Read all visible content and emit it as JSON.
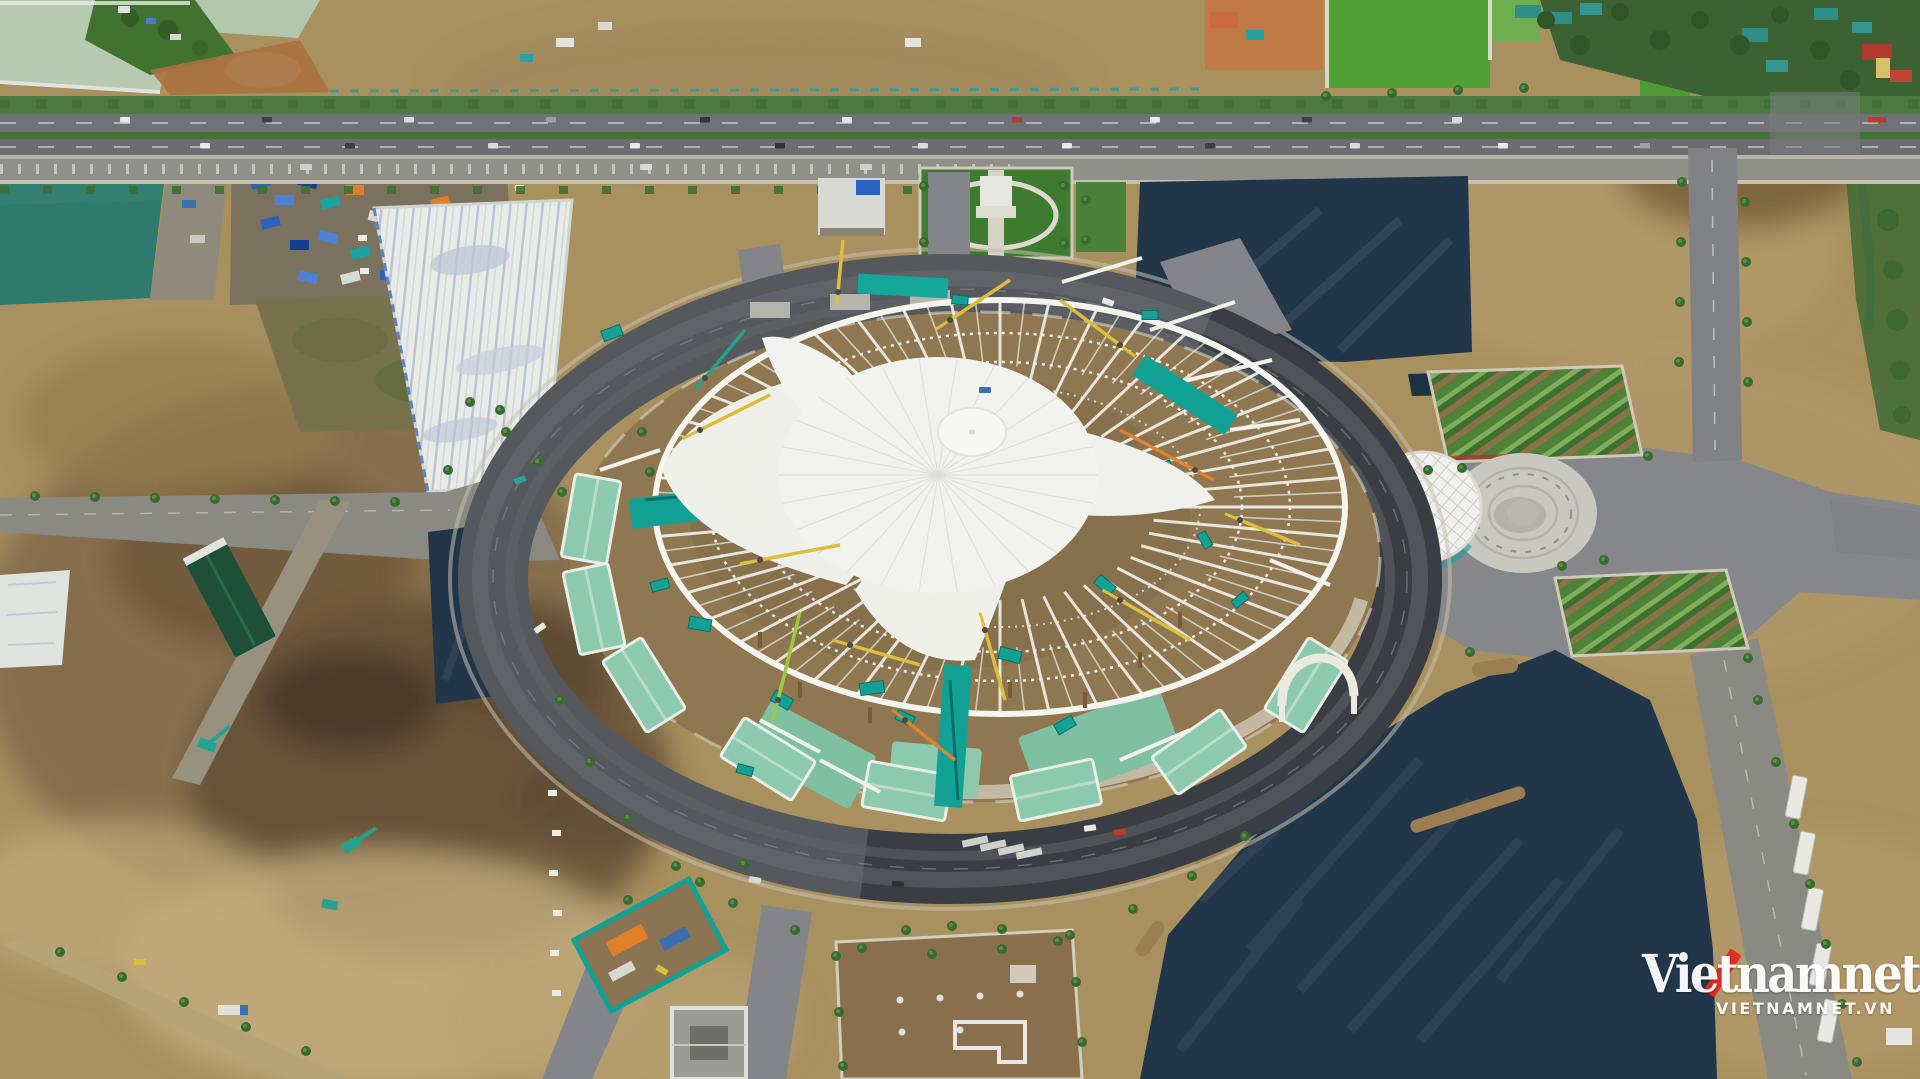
{
  "scene": {
    "type": "aerial-drone-photograph",
    "subject": "Giant circular exhibition dome under construction: white fabric roof and radial steel trusses, surrounded by a ring road, dirt lots, fresh asphalt pads, a highway, fields and ponds"
  },
  "watermark": {
    "brand": "Vietnamnet",
    "site": "VIETNAMNET.VN",
    "text_color": "#ffffff",
    "accent_color": "#e32a1f"
  },
  "palette": {
    "dirt_tan": "#a8905f",
    "mud_dark": "#5d4a33",
    "fresh_asphalt_navy": "#22364a",
    "ring_road_gray": "#55585d",
    "road_gray": "#8a8a82",
    "dome_fabric_white": "#f2f3ee",
    "truss_white": "#eeede6",
    "mint_slab": "#8cc9ae",
    "teal_equipment": "#12a195",
    "field_green": "#52a136",
    "pond_teal": "#2e7a6c",
    "pale_water": "#b7cab1",
    "crane_yellow": "#dcbe3e",
    "crane_orange": "#e0822e"
  }
}
